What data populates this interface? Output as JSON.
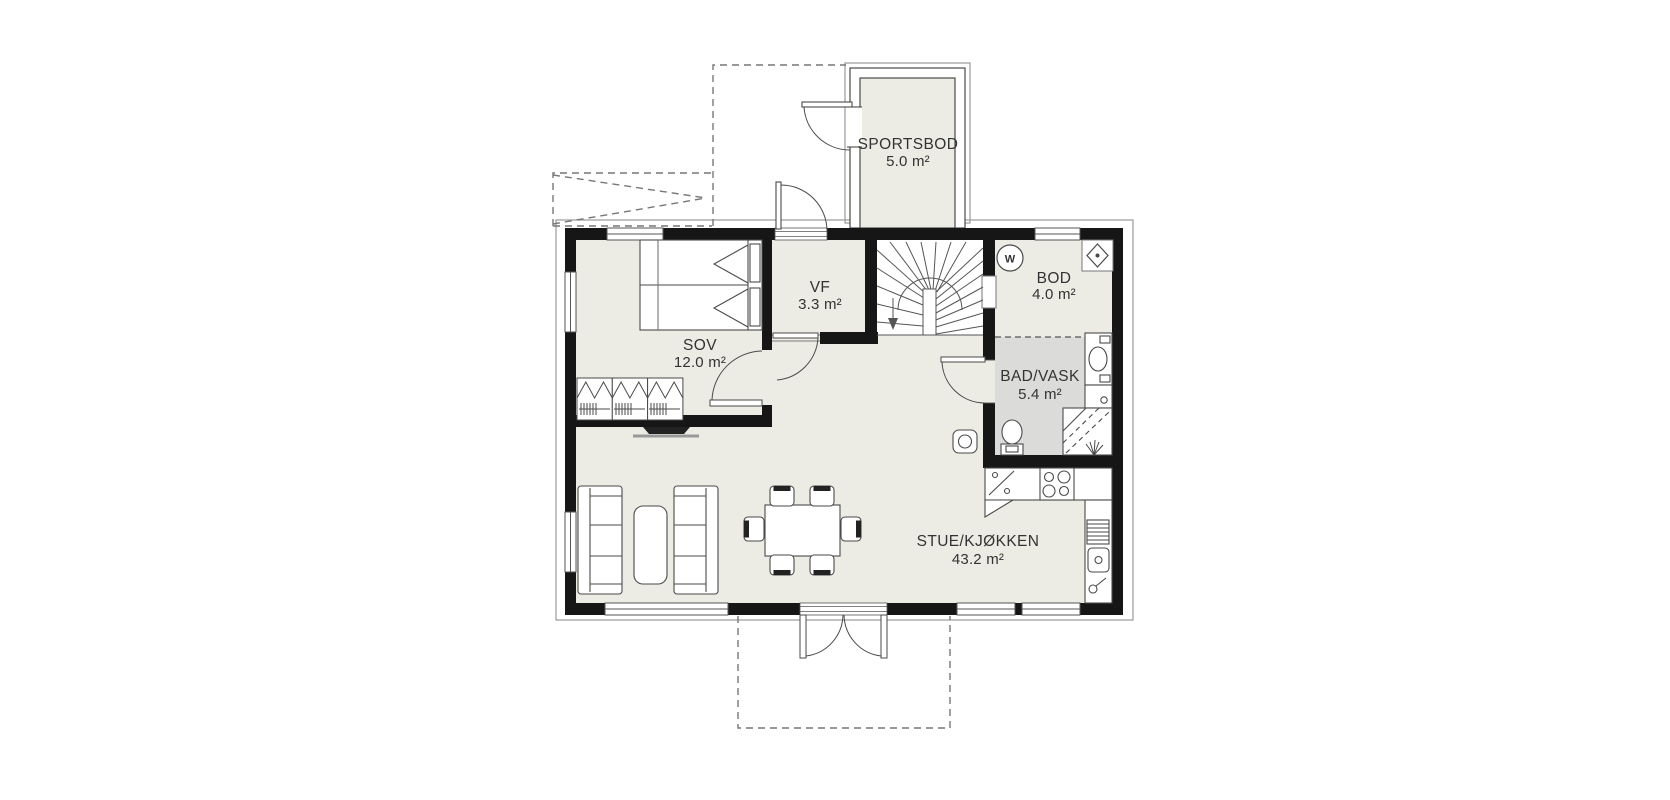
{
  "plan": {
    "title": "floor plan",
    "rooms": [
      {
        "id": "sportsbod",
        "name": "SPORTSBOD",
        "area": "5.0 m²"
      },
      {
        "id": "sov",
        "name": "SOV",
        "area": "12.0 m²"
      },
      {
        "id": "vf",
        "name": "VF",
        "area": "3.3 m²"
      },
      {
        "id": "bod",
        "name": "BOD",
        "area": "4.0 m²"
      },
      {
        "id": "bad-vask",
        "name": "BAD/VASK",
        "area": "5.4 m²"
      },
      {
        "id": "stue",
        "name": "STUE/KJØKKEN",
        "area": "43.2 m²"
      }
    ],
    "symbols": {
      "water_heater": "W"
    },
    "colors": {
      "background": "#FFFFFF",
      "floor": "#ECEBE4",
      "wet_room_floor": "#DBDCDA",
      "wall": "#161616",
      "line": "#4a4a4a",
      "dashed": "#777777"
    }
  }
}
